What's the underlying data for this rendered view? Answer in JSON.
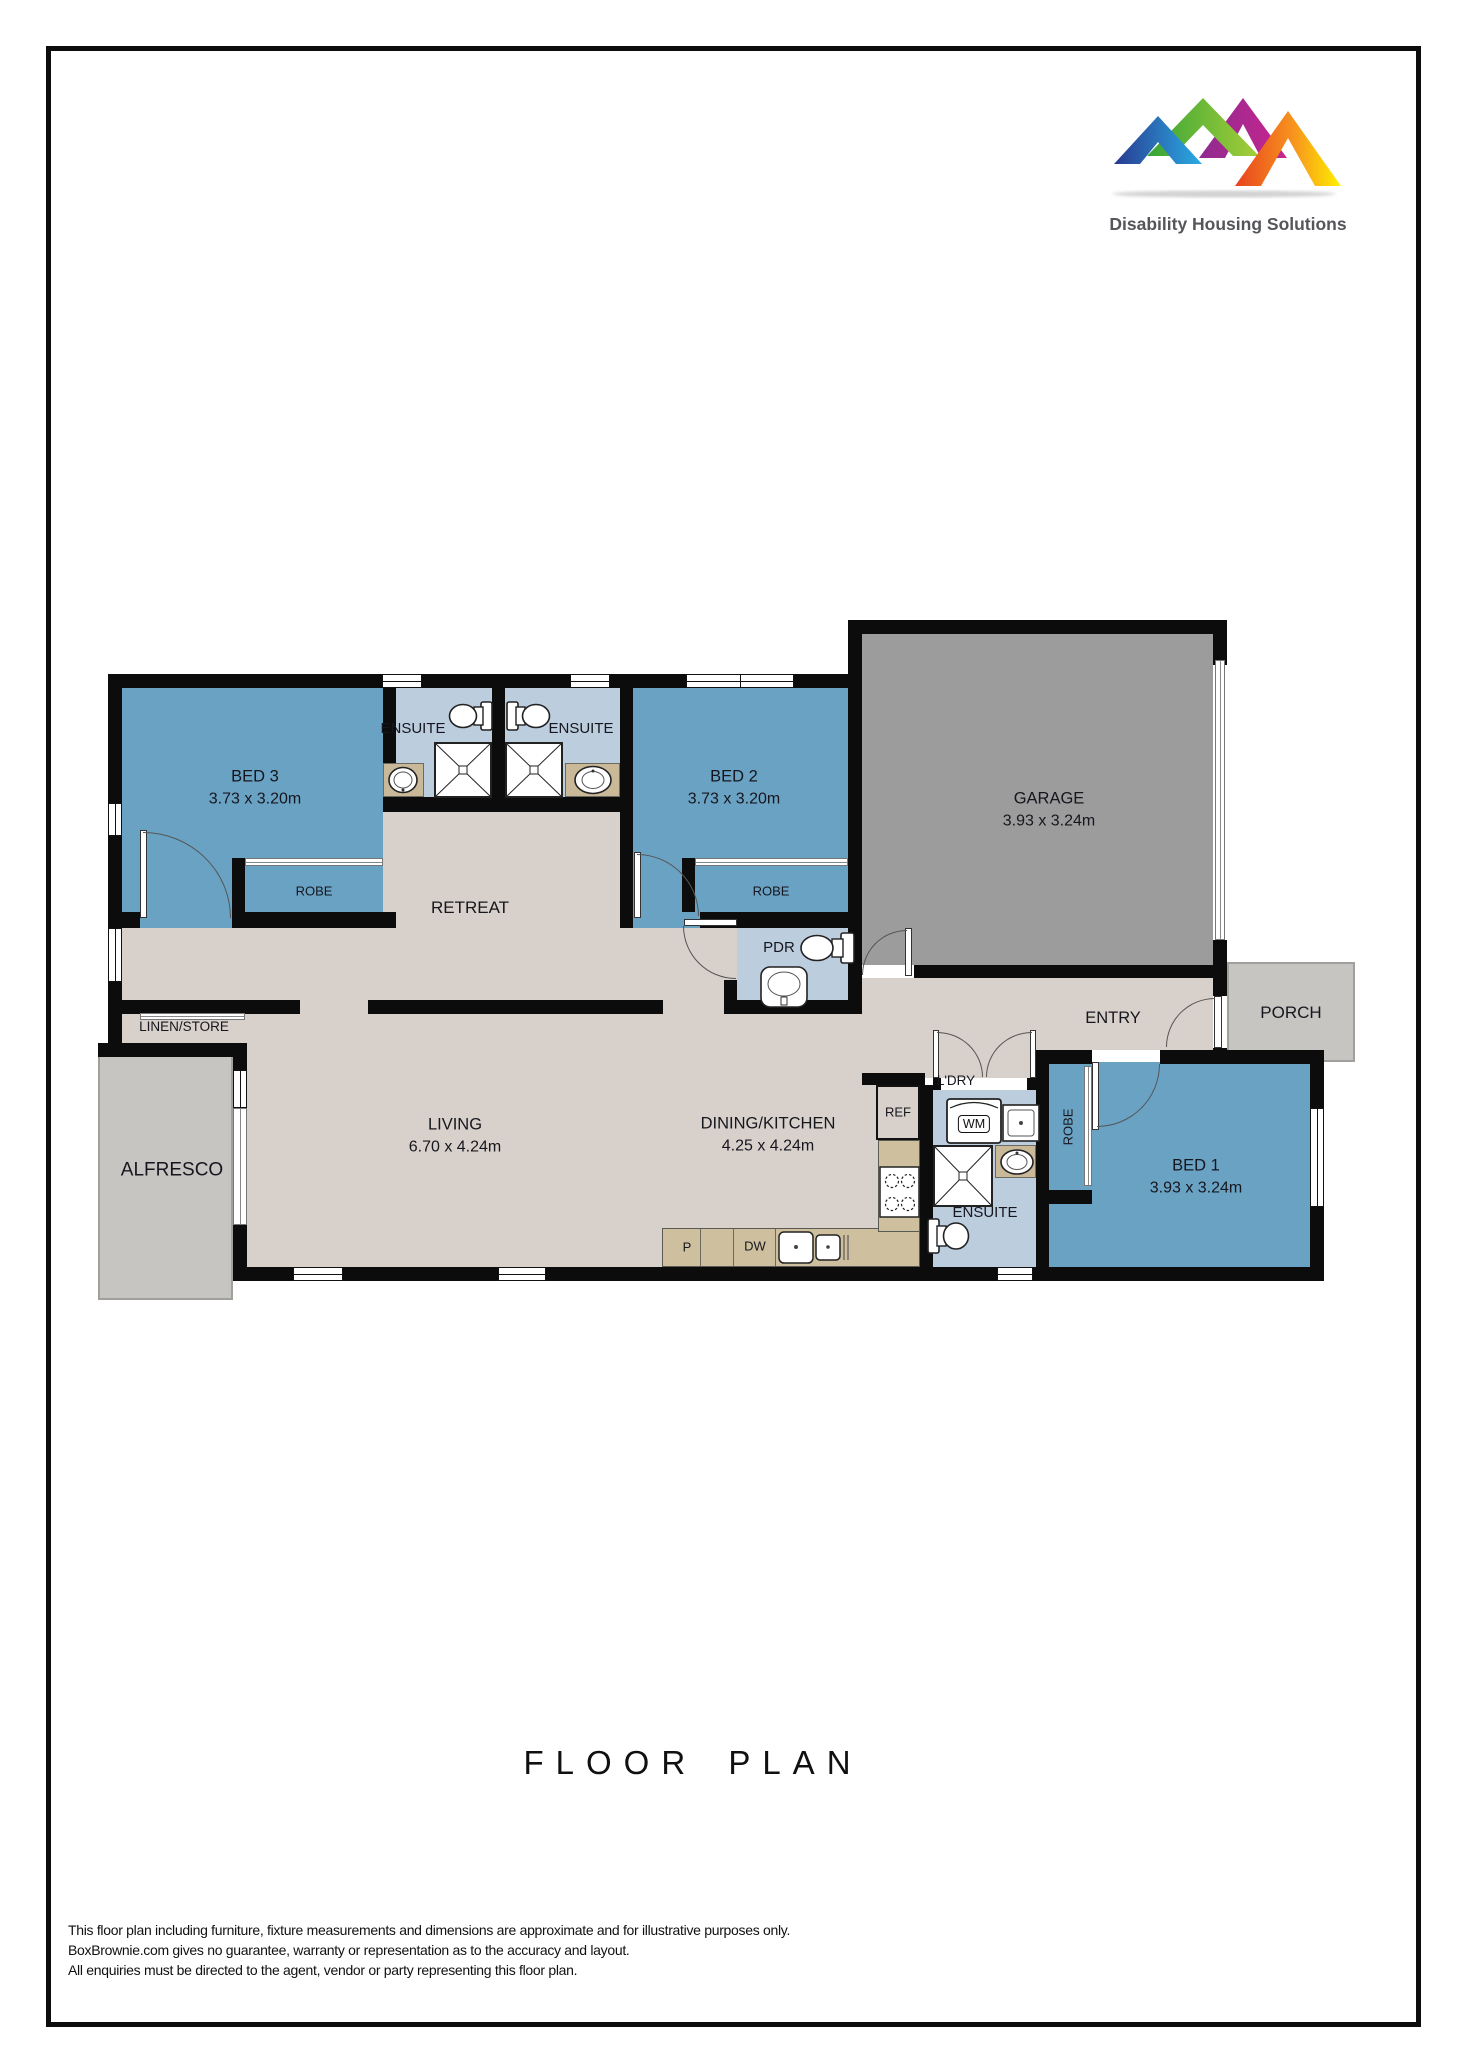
{
  "logo": {
    "brand": "Disability Housing Solutions"
  },
  "page": {
    "title": "FLOOR PLAN",
    "disclaimer": [
      "This floor plan including furniture, fixture measurements and dimensions are approximate and for illustrative purposes only.",
      "BoxBrownie.com gives no guarantee, warranty or representation as to the accuracy and layout.",
      "All enquiries must be directed to the agent, vendor or party representing this floor plan."
    ]
  },
  "rooms": {
    "bed1": {
      "name": "BED 1",
      "dims": "3.93 x 3.24m"
    },
    "bed2": {
      "name": "BED 2",
      "dims": "3.73 x 3.20m"
    },
    "bed3": {
      "name": "BED 3",
      "dims": "3.73 x 3.20m"
    },
    "garage": {
      "name": "GARAGE",
      "dims": "3.93 x 3.24m"
    },
    "living": {
      "name": "LIVING",
      "dims": "6.70 x 4.24m"
    },
    "dining": {
      "name": "DINING/KITCHEN",
      "dims": "4.25 x 4.24m"
    },
    "retreat": "RETREAT",
    "entry": "ENTRY",
    "porch": "PORCH",
    "alfresco": "ALFRESCO",
    "ensuite1": "ENSUITE",
    "ensuite2": "ENSUITE",
    "ensuite3": "ENSUITE",
    "pdr": "PDR",
    "ldry": "L'DRY",
    "linen": "LINEN/STORE",
    "robe1": "ROBE",
    "robe2": "ROBE",
    "robe3": "ROBE",
    "ref": "REF",
    "pantry": "P",
    "dw": "DW",
    "wm": "WM"
  },
  "icons": {
    "toilet": "toilet-icon",
    "shower": "shower-icon",
    "sink": "sink-icon",
    "washing_machine": "washing-machine-icon",
    "cooktop": "cooktop-icon",
    "kitchen_sink": "kitchen-sink-icon"
  },
  "palette": {
    "bedroom": "#6AA2C3",
    "wet_area": "#BCCDDE",
    "floor": "#D8D1CB",
    "garage": "#9C9C9C",
    "outdoor": "#C7C5C2",
    "bench": "#CEC09F",
    "wall": "#0C0C0C",
    "logo_text": "#55565A",
    "logo_blue": [
      "#283A90",
      "#2BACE4"
    ],
    "logo_green": [
      "#35A437",
      "#A6CE39"
    ],
    "logo_magenta": [
      "#8F2B8F",
      "#C9258F"
    ],
    "logo_orange": [
      "#E8431F",
      "#FFF100"
    ]
  }
}
